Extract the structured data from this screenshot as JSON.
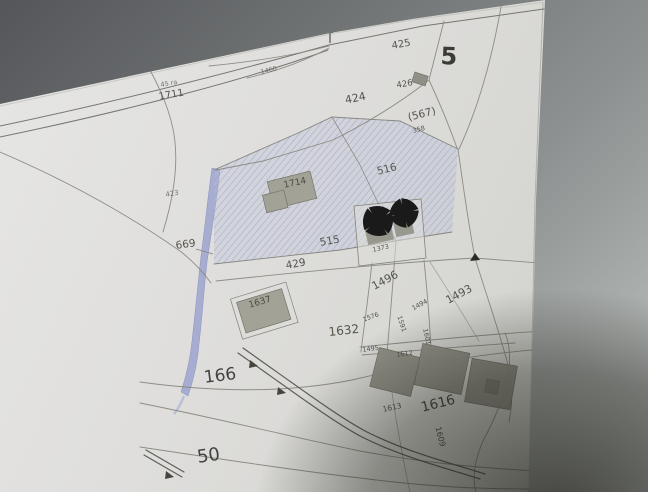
{
  "map": {
    "sheet_title": "Catasto",
    "sheet_number": "5",
    "colors": {
      "paper": "#dfdedc",
      "background_surface": "#6f7273",
      "hatch_blue": "#8890c0",
      "stream_blue": "#99a1cf",
      "building_gray": "#a09f93",
      "ink": "#54544e",
      "symbol_black": "#1a1a1a"
    },
    "icons": [
      {
        "name": "maltese-cross-icon",
        "meaning": "crossed-out building symbol"
      },
      {
        "name": "survey-marker-icon",
        "meaning": "small flag marker on road"
      },
      {
        "name": "boundary-triangle-icon",
        "meaning": "black triangle on parcel line"
      },
      {
        "name": "road-direction-arrow-icon",
        "meaning": "arrowhead on road casing"
      }
    ],
    "labels": [
      {
        "name": "catasto-title",
        "text": "Catasto"
      },
      {
        "name": "parcel-1711",
        "text": "1711"
      },
      {
        "name": "note-above-1711",
        "text": "45 ra"
      },
      {
        "name": "parcel-425",
        "text": "425"
      },
      {
        "name": "sheet-5",
        "text": "5"
      },
      {
        "name": "parcel-424",
        "text": "424"
      },
      {
        "name": "parcel-426",
        "text": "426"
      },
      {
        "name": "parcel-567",
        "text": "(567)"
      },
      {
        "name": "note-358",
        "text": "358"
      },
      {
        "name": "note-1460",
        "text": "1460"
      },
      {
        "name": "parcel-423",
        "text": "423"
      },
      {
        "name": "parcel-516",
        "text": "516"
      },
      {
        "name": "building-1714",
        "text": "1714"
      },
      {
        "name": "parcel-515",
        "text": "515"
      },
      {
        "name": "parcel-669",
        "text": "669"
      },
      {
        "name": "parcel-429",
        "text": "429"
      },
      {
        "name": "note-1373",
        "text": "1373"
      },
      {
        "name": "parcel-1496",
        "text": "1496"
      },
      {
        "name": "parcel-1493",
        "text": "1493"
      },
      {
        "name": "parcel-1494",
        "text": "1494"
      },
      {
        "name": "parcel-1576",
        "text": "1576"
      },
      {
        "name": "parcel-1591",
        "text": "1591"
      },
      {
        "name": "parcel-1601",
        "text": "1601"
      },
      {
        "name": "parcel-1632",
        "text": "1632"
      },
      {
        "name": "building-1637",
        "text": "1637"
      },
      {
        "name": "road-166",
        "text": "166"
      },
      {
        "name": "road-50",
        "text": "50"
      },
      {
        "name": "parcel-1495",
        "text": "1495"
      },
      {
        "name": "parcel-1612",
        "text": "1612"
      },
      {
        "name": "parcel-1613",
        "text": "1613"
      },
      {
        "name": "parcel-1616",
        "text": "1616"
      },
      {
        "name": "parcel-1609",
        "text": "1609"
      }
    ]
  }
}
